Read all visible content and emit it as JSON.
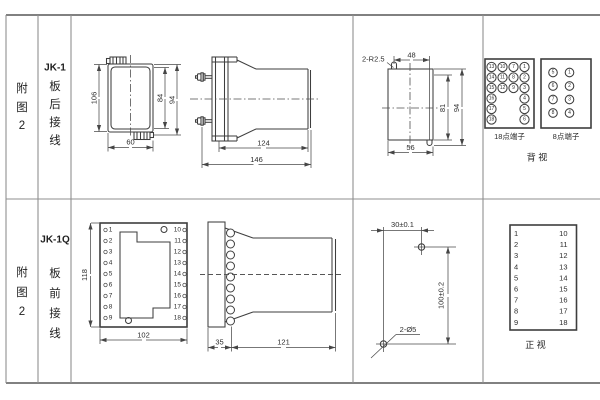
{
  "row_jk1": {
    "fig": [
      "附",
      "图",
      "2"
    ],
    "model": "JK-1",
    "wiring": [
      "板",
      "后",
      "接",
      "线"
    ],
    "rear_view": {
      "dim_height": "106",
      "dim_inner_height": "84",
      "dim_outer_height": "94",
      "dim_width": "60"
    },
    "side_view": {
      "dim_body": "124",
      "dim_total": "146"
    },
    "cutout_view": {
      "slot_radius": "2-R2.5",
      "dim_top": "48",
      "dim_inner": "81",
      "dim_outer": "94",
      "dim_bottom": "56"
    },
    "terminals18": {
      "label": "18点端子",
      "numbers": [
        "13",
        "10",
        "7",
        "1",
        "14",
        "11",
        "8",
        "2",
        "15",
        "12",
        "9",
        "3",
        "16",
        "4",
        "17",
        "5",
        "18",
        "6"
      ]
    },
    "terminals8": {
      "label": "8点端子",
      "numbers": [
        "5",
        "1",
        "6",
        "2",
        "7",
        "3",
        "8",
        "4"
      ]
    },
    "view_label": "背  视"
  },
  "row_jk1q": {
    "fig": [
      "附",
      "图",
      "2"
    ],
    "model": "JK-1Q",
    "wiring": [
      "板",
      "前",
      "接",
      "线"
    ],
    "front_view": {
      "dim_height": "118",
      "dim_width": "102",
      "left_terminals": [
        "1",
        "2",
        "3",
        "4",
        "5",
        "6",
        "7",
        "8",
        "9"
      ],
      "right_terminals": [
        "10",
        "11",
        "12",
        "13",
        "14",
        "15",
        "16",
        "17",
        "18"
      ]
    },
    "side_view": {
      "dim_front": "35",
      "dim_body": "121"
    },
    "drill_view": {
      "dim_horizontal": "30±0.1",
      "dim_vertical": "100±0.2",
      "hole_label": "2-Ø5"
    },
    "terminal_map": {
      "left": [
        "1",
        "2",
        "3",
        "4",
        "5",
        "6",
        "7",
        "8",
        "9"
      ],
      "right": [
        "10",
        "11",
        "12",
        "13",
        "14",
        "15",
        "16",
        "17",
        "18"
      ],
      "view_label": "正  视"
    }
  }
}
